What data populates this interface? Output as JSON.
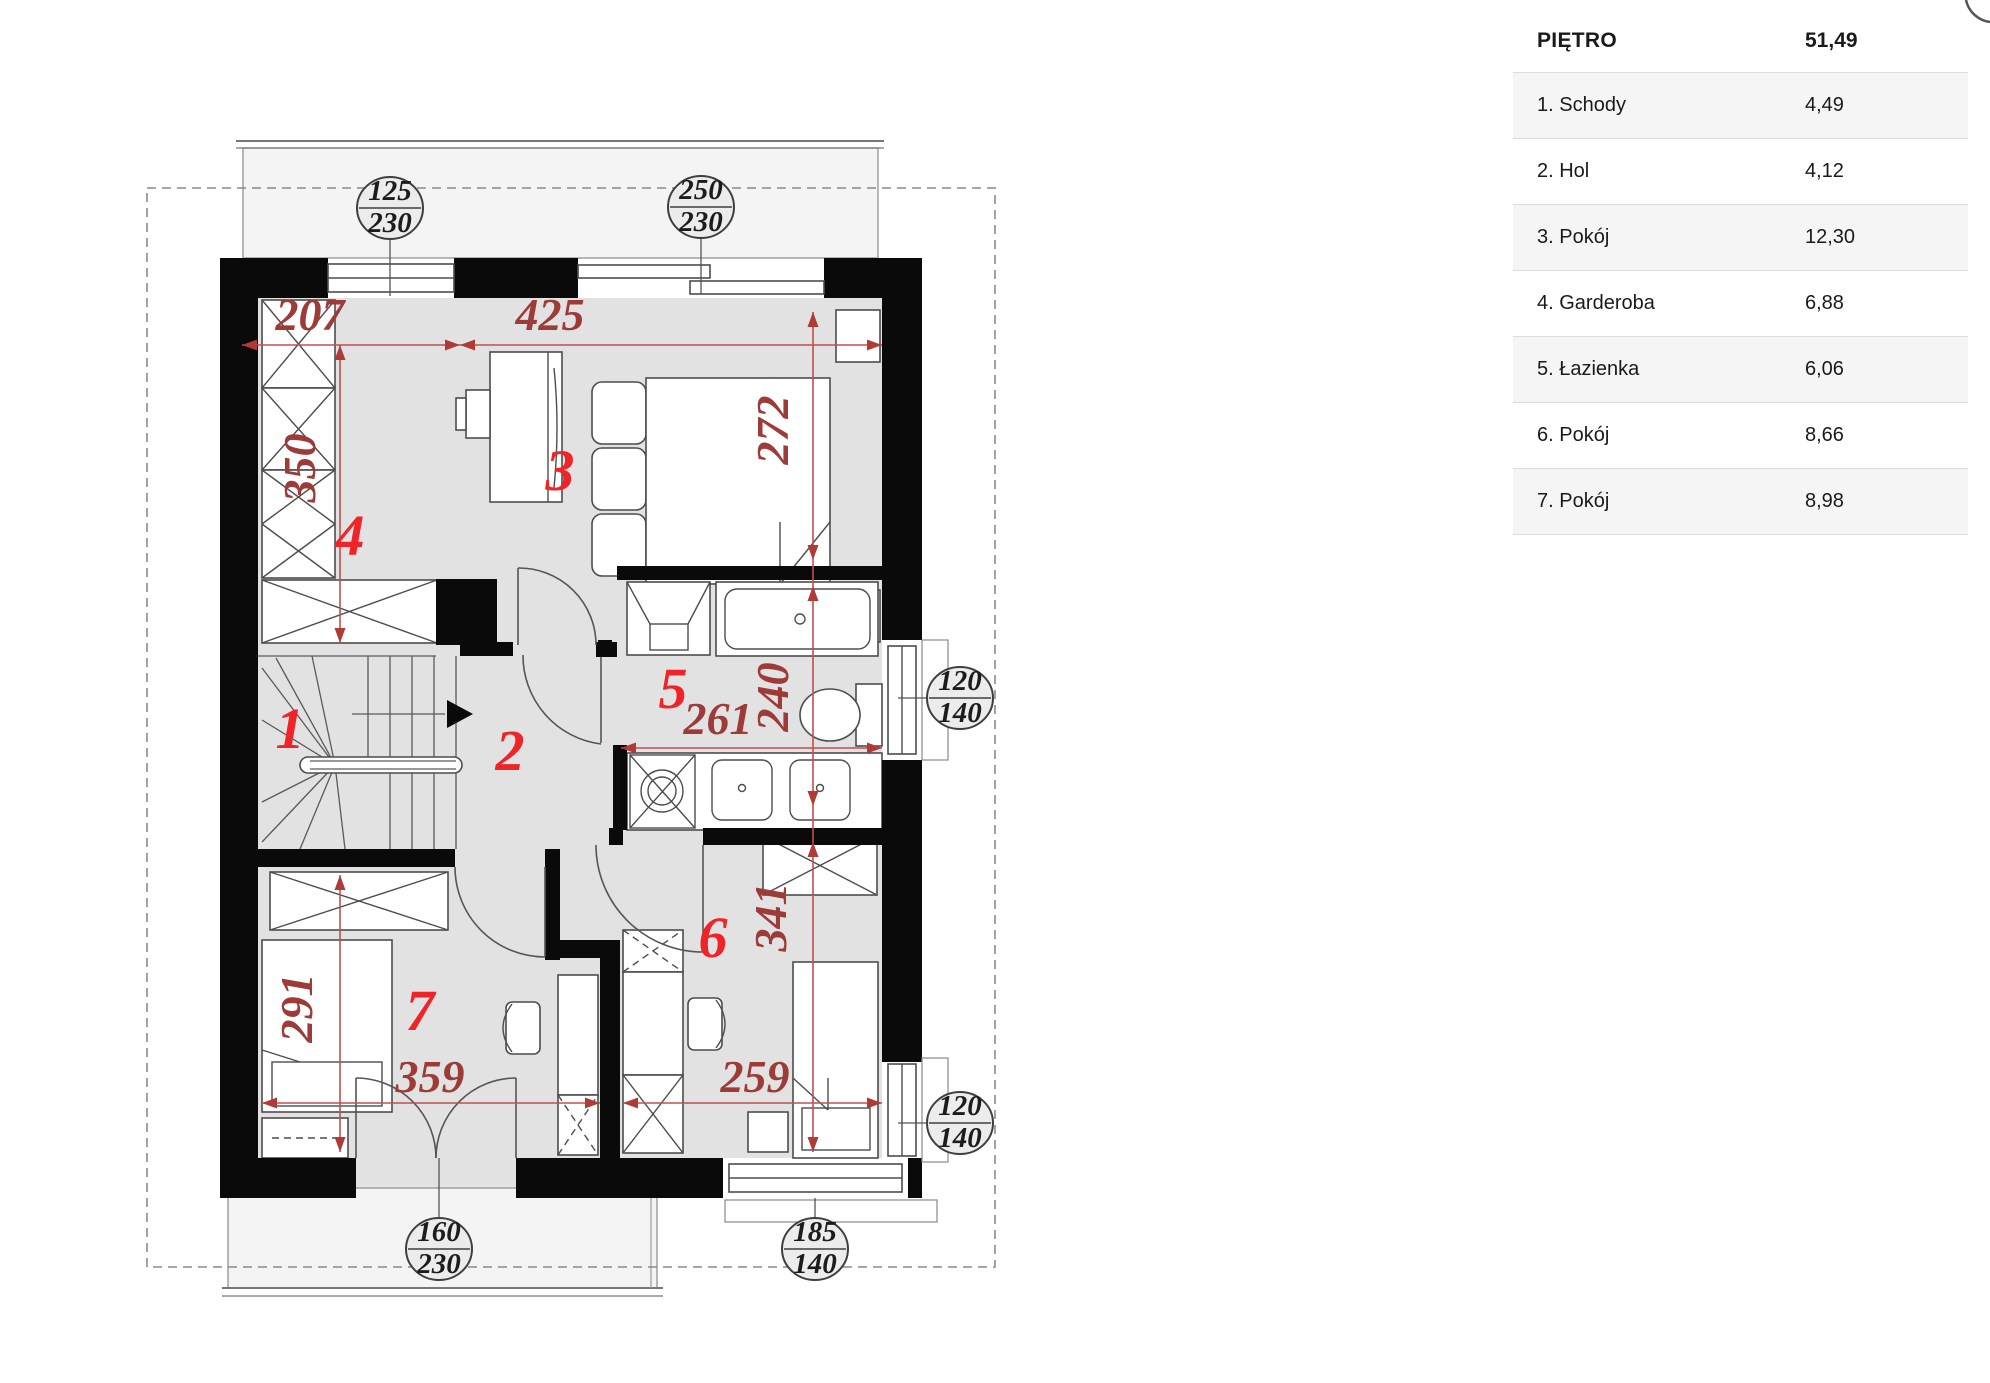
{
  "table": {
    "title": "PIĘTRO",
    "total": "51,49",
    "rows": [
      {
        "label": "1. Schody",
        "value": "4,49"
      },
      {
        "label": "2. Hol",
        "value": "4,12"
      },
      {
        "label": "3. Pokój",
        "value": "12,30"
      },
      {
        "label": "4. Garderoba",
        "value": "6,88"
      },
      {
        "label": "5. Łazienka",
        "value": "6,06"
      },
      {
        "label": "6. Pokój",
        "value": "8,66"
      },
      {
        "label": "7. Pokój",
        "value": "8,98"
      }
    ]
  },
  "plan": {
    "rooms": [
      "1",
      "2",
      "3",
      "4",
      "5",
      "6",
      "7"
    ],
    "dims": {
      "d207": "207",
      "d425": "425",
      "d350": "350",
      "d272": "272",
      "d261": "261",
      "d240": "240",
      "d341": "341",
      "d259": "259",
      "d291": "291",
      "d359": "359"
    },
    "windows": [
      {
        "w": "125",
        "h": "230"
      },
      {
        "w": "250",
        "h": "230"
      },
      {
        "w": "120",
        "h": "140"
      },
      {
        "w": "120",
        "h": "140"
      },
      {
        "w": "160",
        "h": "230"
      },
      {
        "w": "185",
        "h": "140"
      }
    ],
    "colors": {
      "room_number": "#ee2428",
      "dimension_text": "#9c3b38",
      "dimension_line": "#c0504d",
      "wall": "#0a0a0a",
      "floor": "#e2e2e2",
      "terrace": "#f4f4f4"
    }
  }
}
